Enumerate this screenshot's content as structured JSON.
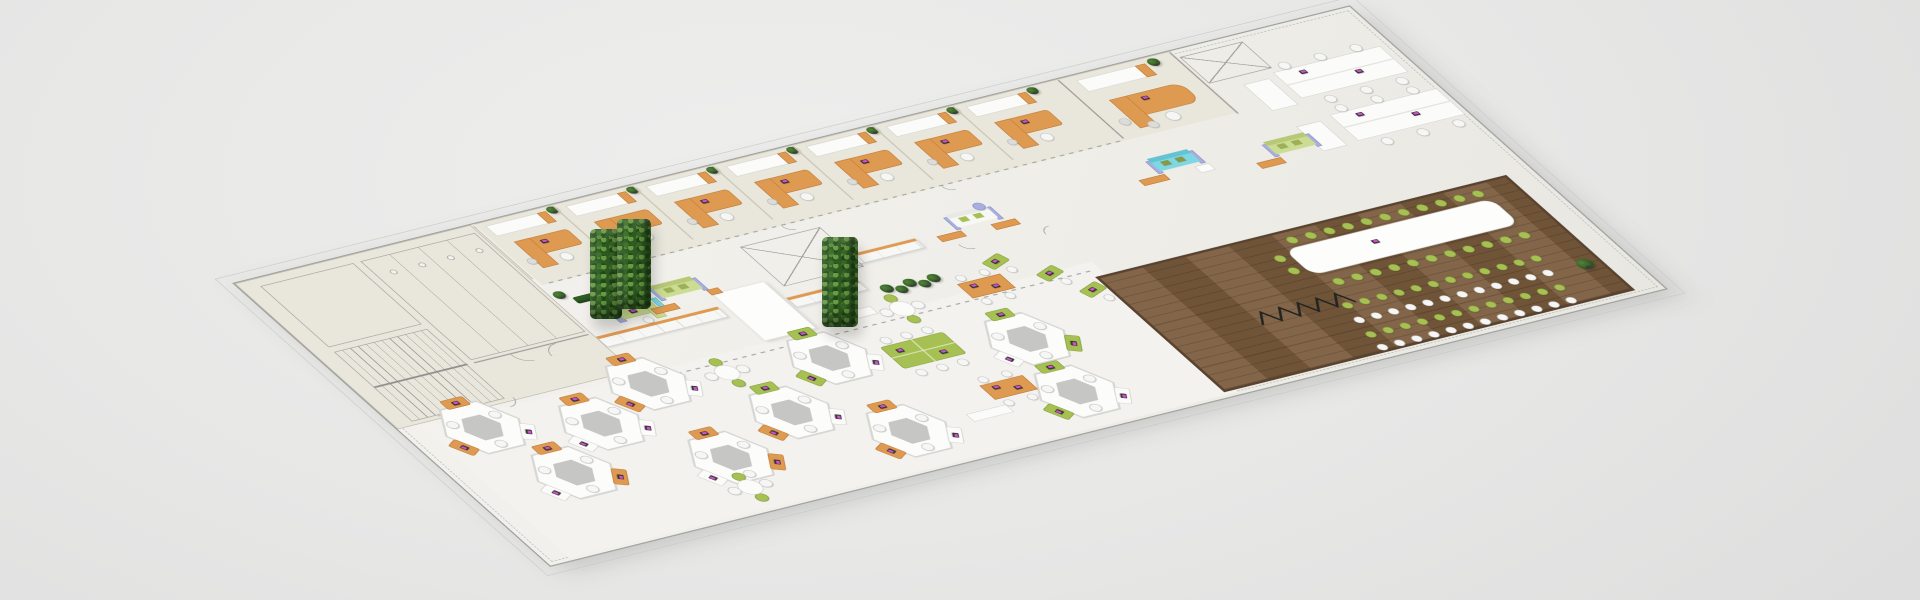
{
  "scene": {
    "kind": "isometric-office-floorplan-3d-render",
    "canvas": {
      "w": 1920,
      "h": 600,
      "background": "#e7e7e6"
    },
    "palette": {
      "carpet": "#f1f0ec",
      "wing": "#e9e7dc",
      "openPlan": "#f3f2ee",
      "wood": "#7b5c3e",
      "orange": "#df9a52",
      "green": "#a6c053",
      "lime": "#ccdc92",
      "cyan": "#7ed7e2",
      "lavender": "#a8aede",
      "white": "#fbfbfa",
      "plantGreen": "#2f5d23",
      "linework": "#9b9b99",
      "laptopScreen": "#d14fd1"
    },
    "plate": {
      "x": 232,
      "y": 283,
      "w": 1560,
      "h": 600,
      "matrix": [
        0.71474,
        -0.17756,
        0.52667,
        0.47,
        232,
        283
      ]
    },
    "sofaColors": {
      "lime": [
        "#ccdc92",
        "#b7c877",
        "#9cb05a"
      ],
      "white": [
        "#f7f7f6",
        "#e8e8e6",
        "#a6c053"
      ],
      "cyan": [
        "#7ed7e2",
        "#63c3d2",
        "#86994a"
      ]
    },
    "items": [
      {
        "t": "zone",
        "c": "zwing",
        "x": 0,
        "y": 0,
        "w": 330,
        "h": 310,
        "n": "linework-wing-floor"
      },
      {
        "t": "zone",
        "c": "zoffice",
        "x": 335,
        "y": 0,
        "w": 975,
        "h": 130,
        "n": "office-row-floor"
      },
      {
        "t": "zone",
        "c": "zopen",
        "x": 30,
        "y": 318,
        "w": 935,
        "h": 277,
        "n": "open-plan-floor"
      },
      {
        "t": "wood",
        "x": 950,
        "y": 345,
        "w": 575,
        "h": 245,
        "n": "conference-wood-floor"
      },
      {
        "t": "rect",
        "c": "f-lw",
        "x": 25,
        "y": 15,
        "w": 130,
        "h": 130,
        "n": "plan-room-outline"
      },
      {
        "t": "stairs",
        "x": 25,
        "y": 155,
        "w": 130,
        "h": 148,
        "n": "staircase"
      },
      {
        "t": "bath",
        "x": 165,
        "y": 15,
        "w": 160,
        "h": 210,
        "n": "restrooms"
      },
      {
        "t": "line",
        "x": 165,
        "y": 230,
        "w": 160,
        "h": 1.5,
        "n": "wall-line"
      },
      {
        "t": "arc",
        "x": 215,
        "y": 232,
        "d": 20,
        "rot": 0,
        "n": "door-arc"
      },
      {
        "t": "arc",
        "x": 258,
        "y": 232,
        "d": 20,
        "rot": 90,
        "n": "door-arc"
      },
      {
        "t": "arc",
        "x": 60,
        "y": 304,
        "d": 16,
        "rot": 180,
        "n": "door-arc"
      },
      {
        "t": "arc",
        "x": 150,
        "y": 304,
        "d": 16,
        "rot": 270,
        "n": "door-arc"
      },
      {
        "t": "bay",
        "x": 345
      },
      {
        "t": "bay",
        "x": 457
      },
      {
        "t": "bay",
        "x": 569
      },
      {
        "t": "bay",
        "x": 681
      },
      {
        "t": "bay",
        "x": 793
      },
      {
        "t": "bay",
        "x": 905
      },
      {
        "t": "bay",
        "x": 1017
      },
      {
        "t": "dash",
        "x": 345,
        "y": 128,
        "w": 800,
        "h": 2,
        "n": "glass-front-line"
      },
      {
        "t": "arc",
        "x": 445,
        "y": 130,
        "d": 12,
        "rot": 0,
        "n": "door-arc"
      },
      {
        "t": "arc",
        "x": 669,
        "y": 130,
        "d": 12,
        "rot": 0,
        "n": "door-arc"
      },
      {
        "t": "arc",
        "x": 893,
        "y": 130,
        "d": 12,
        "rot": 0,
        "n": "door-arc"
      },
      {
        "t": "line",
        "x": 1150,
        "y": 2,
        "w": 2,
        "h": 124,
        "n": "office-divider"
      },
      {
        "t": "rect",
        "c": "f-w",
        "x": 1170,
        "y": 10,
        "w": 96,
        "h": 24,
        "n": "bookshelf"
      },
      {
        "t": "rect",
        "c": "f-or",
        "x": 1252,
        "y": 10,
        "w": 14,
        "h": 24,
        "n": "bookshelf-end"
      },
      {
        "t": "plant",
        "x": 1270,
        "y": 4,
        "d": 15,
        "n": "potted-plant"
      },
      {
        "t": "rect",
        "c": "f-or",
        "x": 1182,
        "y": 56,
        "w": 100,
        "h": 40,
        "r": 16,
        "n": "executive-desk"
      },
      {
        "t": "rect",
        "c": "f-or",
        "x": 1182,
        "y": 56,
        "w": 24,
        "h": 60,
        "n": "desk-return"
      },
      {
        "t": "laptop",
        "x": 1220,
        "y": 64,
        "n": "laptop"
      },
      {
        "t": "chair",
        "c": "w",
        "x": 1224,
        "y": 100,
        "d": 18,
        "n": "task-chair"
      },
      {
        "t": "chair",
        "c": "gray",
        "x": 1166,
        "y": 92,
        "d": 14,
        "n": "guest-chair"
      },
      {
        "t": "chair",
        "c": "gray",
        "x": 1194,
        "y": 108,
        "d": 14,
        "n": "guest-chair"
      },
      {
        "t": "line",
        "x": 1306,
        "y": 2,
        "w": 2,
        "h": 130,
        "n": "office-divider"
      },
      {
        "t": "xbox",
        "x": 1312,
        "y": 14,
        "w": 88,
        "h": 56,
        "n": "elevator-core"
      },
      {
        "t": "benchdesk",
        "x": 1395,
        "y": 78,
        "n": "bench-workstation"
      },
      {
        "t": "benchdesk",
        "x": 1405,
        "y": 172,
        "n": "bench-workstation"
      },
      {
        "t": "rect",
        "c": "f-w",
        "x": 1348,
        "y": 86,
        "w": 36,
        "h": 56,
        "n": "storage-cabinet"
      },
      {
        "t": "rect",
        "c": "f-w",
        "x": 1354,
        "y": 178,
        "w": 34,
        "h": 52,
        "n": "storage-cabinet"
      },
      {
        "t": "cabrow",
        "x": 330,
        "y": 238,
        "w": 170,
        "h": 22,
        "n": "locker-row"
      },
      {
        "t": "cabrow",
        "x": 586,
        "y": 252,
        "w": 100,
        "h": 20,
        "n": "locker-row"
      },
      {
        "t": "cabrow",
        "x": 688,
        "y": 206,
        "w": 112,
        "h": 20,
        "n": "locker-row"
      },
      {
        "t": "rect",
        "c": "f-wall",
        "x": 510,
        "y": 215,
        "w": 72,
        "h": 100,
        "n": "partition-wall"
      },
      {
        "t": "xbox",
        "x": 598,
        "y": 148,
        "w": 112,
        "h": 84,
        "n": "elevator-core"
      },
      {
        "t": "recep",
        "x": 374,
        "y": 195,
        "n": "reception-desk"
      },
      {
        "t": "rect",
        "c": "f-hedge",
        "x": 352,
        "y": 163,
        "w": 64,
        "h": 13,
        "n": "hedge"
      },
      {
        "t": "sofa",
        "c": "lime",
        "x": 446,
        "y": 176,
        "n": "sofa-lime"
      },
      {
        "t": "rect",
        "c": "f-or",
        "x": 424,
        "y": 214,
        "w": 34,
        "h": 12,
        "n": "coffee-bench"
      },
      {
        "t": "rect",
        "c": "f-or",
        "x": 508,
        "y": 206,
        "w": 16,
        "h": 11,
        "n": "side-table"
      },
      {
        "t": "sofa",
        "c": "white",
        "x": 856,
        "y": 180,
        "n": "sofa-white"
      },
      {
        "t": "rect",
        "c": "f-or",
        "x": 826,
        "y": 212,
        "w": 34,
        "h": 12,
        "n": "coffee-bench"
      },
      {
        "t": "rect",
        "c": "f-or",
        "x": 900,
        "y": 214,
        "w": 34,
        "h": 12,
        "n": "coffee-bench"
      },
      {
        "t": "chair",
        "c": "lav",
        "x": 902,
        "y": 172,
        "d": 15,
        "n": "armchair"
      },
      {
        "t": "sofa",
        "c": "cyan",
        "x": 1146,
        "y": 170,
        "n": "sofa-cyan"
      },
      {
        "t": "rect",
        "c": "f-or",
        "x": 1116,
        "y": 202,
        "w": 36,
        "h": 12,
        "n": "coffee-bench"
      },
      {
        "t": "rect",
        "c": "f-w",
        "x": 1194,
        "y": 202,
        "w": 20,
        "h": 14,
        "n": "ottoman"
      },
      {
        "t": "sofa",
        "c": "lime",
        "x": 1294,
        "y": 190,
        "n": "sofa-lime"
      },
      {
        "t": "rect",
        "c": "f-or",
        "x": 1266,
        "y": 222,
        "w": 34,
        "h": 12,
        "n": "coffee-bench"
      },
      {
        "t": "plant",
        "x": 700,
        "y": 270,
        "d": 16,
        "n": "potted-plant"
      },
      {
        "t": "plant",
        "x": 716,
        "y": 278,
        "d": 15,
        "n": "potted-plant"
      },
      {
        "t": "plant",
        "x": 732,
        "y": 270,
        "d": 16,
        "n": "potted-plant"
      },
      {
        "t": "plant",
        "x": 748,
        "y": 278,
        "d": 15,
        "n": "potted-plant"
      },
      {
        "t": "plant",
        "x": 764,
        "y": 272,
        "d": 16,
        "n": "potted-plant"
      },
      {
        "t": "plant",
        "x": 334,
        "y": 146,
        "d": 15,
        "n": "potted-plant"
      },
      {
        "t": "dash",
        "x": 335,
        "y": 332,
        "w": 620,
        "h": 2,
        "n": "boundary-line"
      },
      {
        "t": "arc",
        "x": 840,
        "y": 234,
        "d": 14,
        "rot": 0,
        "n": "door-arc"
      },
      {
        "t": "arc",
        "x": 948,
        "y": 240,
        "d": 14,
        "rot": 90,
        "n": "door-arc"
      },
      {
        "t": "pod",
        "x": 95,
        "y": 342,
        "a": [
          "or",
          "w",
          "or"
        ],
        "n": "hex-workpod"
      },
      {
        "t": "pod",
        "x": 140,
        "y": 455,
        "a": [
          "or",
          "or",
          "w"
        ],
        "n": "hex-workpod"
      },
      {
        "t": "pod",
        "x": 230,
        "y": 385,
        "a": [
          "or",
          "w",
          "w"
        ],
        "n": "hex-workpod"
      },
      {
        "t": "pod",
        "x": 330,
        "y": 338,
        "a": [
          "or",
          "w",
          "or"
        ],
        "n": "hex-workpod"
      },
      {
        "t": "pod",
        "x": 330,
        "y": 495,
        "a": [
          "or",
          "or",
          "w"
        ],
        "n": "hex-workpod"
      },
      {
        "t": "pod",
        "x": 452,
        "y": 445,
        "a": [
          "gr",
          "w",
          "or"
        ],
        "n": "hex-workpod"
      },
      {
        "t": "pod",
        "x": 560,
        "y": 370,
        "a": [
          "gr",
          "w",
          "gr"
        ],
        "n": "hex-workpod"
      },
      {
        "t": "pod",
        "x": 558,
        "y": 524,
        "a": [
          "or",
          "w",
          "or"
        ],
        "n": "hex-workpod"
      },
      {
        "t": "pod",
        "x": 800,
        "y": 420,
        "a": [
          "gr",
          "gr",
          "w"
        ],
        "n": "hex-workpod"
      },
      {
        "t": "pod",
        "x": 790,
        "y": 528,
        "a": [
          "gr",
          "w",
          "gr"
        ],
        "n": "hex-workpod"
      },
      {
        "t": "rtable",
        "x": 315,
        "y": 552,
        "n": "round-meeting-table"
      },
      {
        "t": "rtable",
        "x": 700,
        "y": 318,
        "n": "round-meeting-table"
      },
      {
        "t": "rtable",
        "x": 430,
        "y": 352,
        "n": "round-meeting-table"
      },
      {
        "t": "gtable",
        "x": 672,
        "y": 396,
        "n": "green-team-table"
      },
      {
        "t": "gdesk",
        "x": 848,
        "y": 268,
        "rot": -20,
        "n": "green-desk"
      },
      {
        "t": "gdesk",
        "x": 893,
        "y": 310,
        "rot": -20,
        "n": "green-desk"
      },
      {
        "t": "gdesk",
        "x": 920,
        "y": 355,
        "rot": -20,
        "n": "green-desk"
      },
      {
        "t": "otable",
        "x": 790,
        "y": 300,
        "n": "orange-team-table"
      },
      {
        "t": "otable",
        "x": 690,
        "y": 478,
        "n": "orange-team-table"
      },
      {
        "t": "rect",
        "c": "f-w",
        "x": 612,
        "y": 300,
        "w": 56,
        "h": 16,
        "n": "storage-cabinet"
      },
      {
        "t": "rect",
        "c": "f-w",
        "x": 640,
        "y": 520,
        "w": 56,
        "h": 16,
        "n": "storage-cabinet"
      },
      {
        "t": "conftable",
        "x": 1190,
        "y": 378,
        "w": 290,
        "h": 54,
        "n": "conference-table"
      },
      {
        "t": "laptop",
        "x": 1296,
        "y": 398,
        "n": "laptop"
      },
      {
        "t": "chairrow",
        "x": 1204,
        "y": 358,
        "nn": 11,
        "s": 26,
        "d": 14,
        "c": "gr",
        "n": "conference-chair-row"
      },
      {
        "t": "chairrow",
        "x": 1204,
        "y": 446,
        "nn": 11,
        "s": 26,
        "d": 14,
        "c": "gr",
        "n": "conference-chair-row"
      },
      {
        "t": "chair",
        "c": "gr",
        "x": 1168,
        "y": 384,
        "d": 14,
        "n": "conference-chair"
      },
      {
        "t": "chair",
        "c": "gr",
        "x": 1168,
        "y": 410,
        "d": 14,
        "n": "conference-chair"
      },
      {
        "t": "chairrow",
        "x": 1185,
        "y": 490,
        "nn": 12,
        "s": 24,
        "d": 13,
        "c": "gr",
        "n": "audience-chair-row"
      },
      {
        "t": "chairrow",
        "x": 1180,
        "y": 519,
        "nn": 12,
        "s": 24,
        "d": 13,
        "c": "w",
        "n": "audience-chair-row"
      },
      {
        "t": "chairrow",
        "x": 1175,
        "y": 548,
        "nn": 12,
        "s": 24,
        "d": 13,
        "c": "gr",
        "n": "audience-chair-row"
      },
      {
        "t": "chairrow",
        "x": 1172,
        "y": 574,
        "nn": 12,
        "s": 24,
        "d": 13,
        "c": "w",
        "n": "audience-chair-row"
      },
      {
        "t": "zigzag",
        "x": 1075,
        "y": 462,
        "w": 130,
        "h": 40,
        "n": "cable-zigzag"
      },
      {
        "t": "plant",
        "x": 1492,
        "y": 516,
        "d": 20,
        "n": "potted-plant"
      }
    ],
    "overlays": [
      {
        "x": 590,
        "y": 229,
        "w": 32,
        "h": 90,
        "n": "green-wall-column"
      },
      {
        "x": 617,
        "y": 219,
        "w": 34,
        "h": 90,
        "n": "green-wall-column"
      },
      {
        "x": 822,
        "y": 237,
        "w": 36,
        "h": 90,
        "n": "green-wall-column"
      }
    ]
  }
}
